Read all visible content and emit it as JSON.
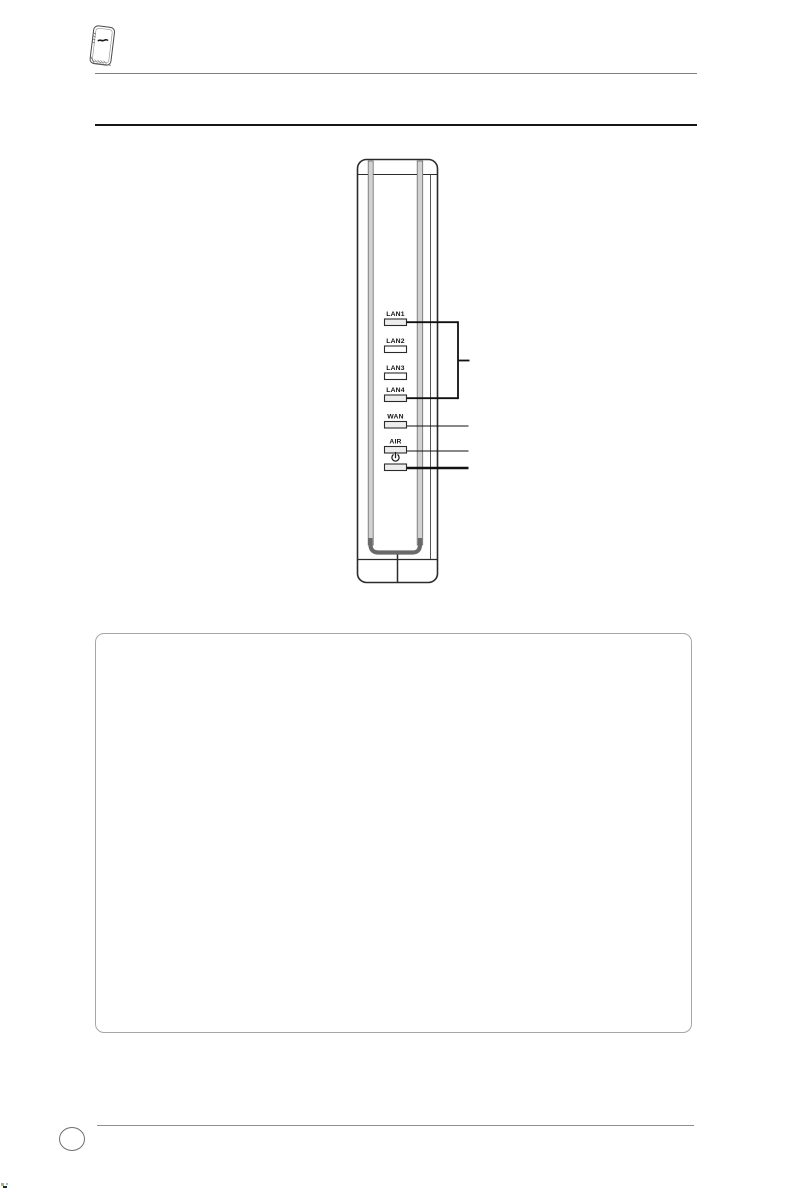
{
  "page": {
    "kind": "router manual front-panel page"
  },
  "header": {
    "device_icon": "router-thumbnail-icon"
  },
  "diagram": {
    "device": "vertical wireless router front panel",
    "led_labels": [
      "LAN1",
      "LAN2",
      "LAN3",
      "LAN4",
      "WAN",
      "AIR"
    ],
    "power_icon": "power-standby-icon",
    "colors": {
      "outline": "#2b2b2b",
      "stripe_fill": "#d2d2d2",
      "stripe_edge": "#6a6a6a",
      "led_fill": "#ededed",
      "callout": "#111111"
    }
  },
  "note_box": {
    "content": ""
  },
  "footer": {
    "page_number": ""
  }
}
